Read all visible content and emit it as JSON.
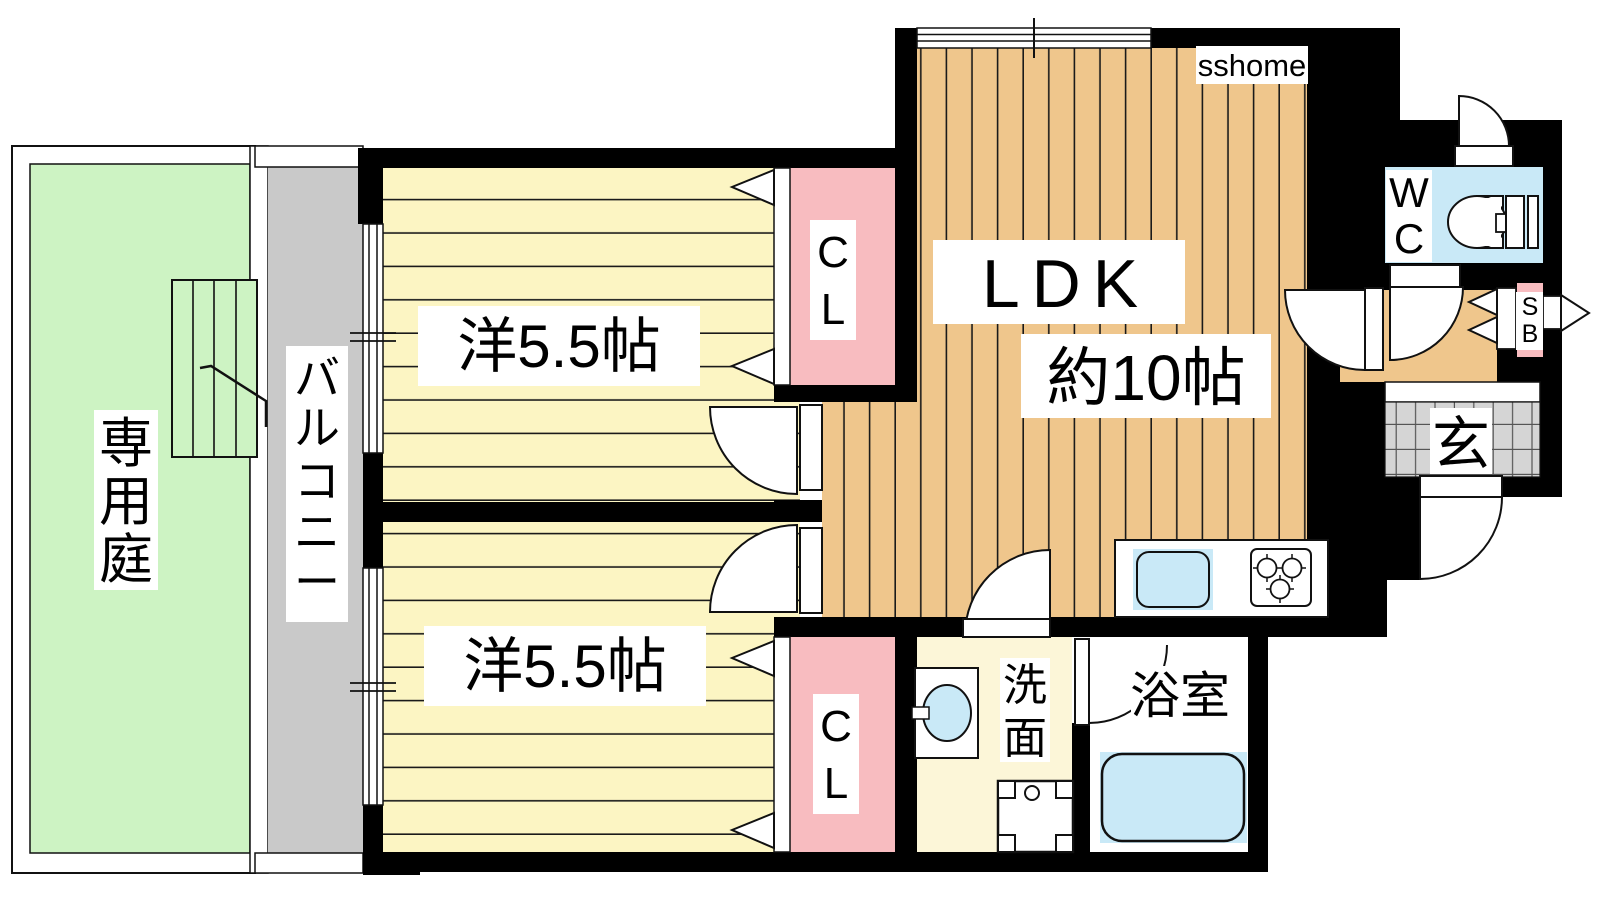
{
  "floorplan": {
    "brand": "sshome",
    "garden": {
      "label": "専用庭"
    },
    "balcony": {
      "label": "バルコニー"
    },
    "bedroom1": {
      "label": "洋5.5帖"
    },
    "bedroom2": {
      "label": "洋5.5帖"
    },
    "ldk": {
      "label": "LDK",
      "size": "約10帖"
    },
    "closet1": {
      "label": "CL"
    },
    "closet2": {
      "label": "CL"
    },
    "wc": {
      "label": "WC"
    },
    "shoebox": {
      "label": "SB"
    },
    "entrance": {
      "label": "玄"
    },
    "washroom": {
      "label": "洗面"
    },
    "bathroom": {
      "label": "浴室"
    },
    "colors": {
      "wood": "#EFC68C",
      "room_yellow": "#FCF5C3",
      "washroom_yellow": "#FCF6D8",
      "closet_pink": "#F8BCC0",
      "water_blue": "#C9E9F7",
      "garden_green": "#CDF3C3",
      "balcony_gray": "#C9C9C9",
      "tile_gray": "#D5D5D5",
      "wall_black": "#000000"
    }
  }
}
